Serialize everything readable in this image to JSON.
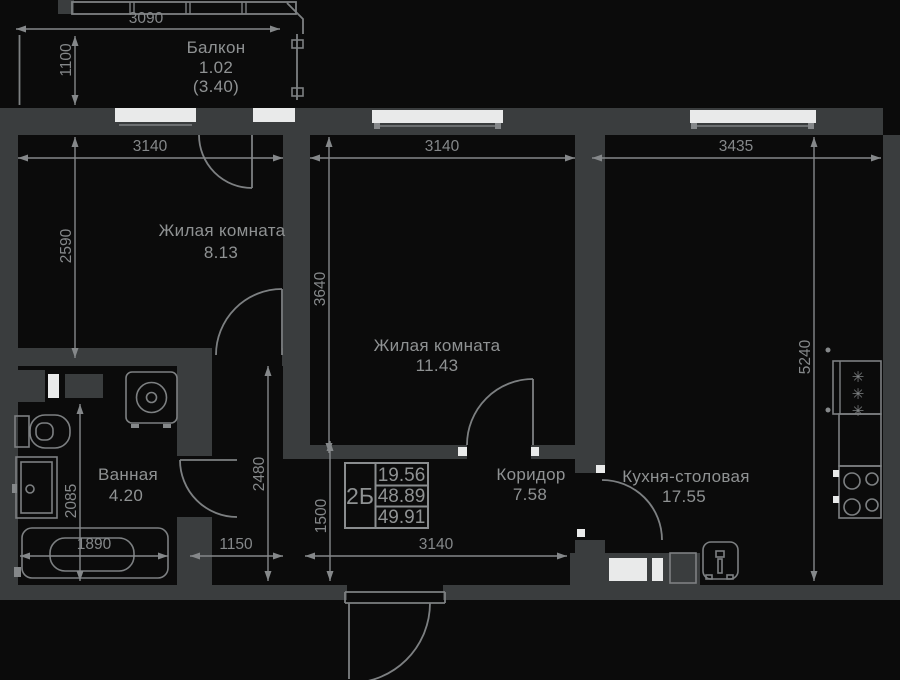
{
  "plan": {
    "balcony": {
      "name": "Балкон",
      "area": "1.02",
      "area_total": "(3.40)"
    },
    "rooms": {
      "living1": {
        "name": "Жилая комната",
        "area": "8.13"
      },
      "living2": {
        "name": "Жилая комната",
        "area": "11.43"
      },
      "bathroom": {
        "name": "Ванная",
        "area": "4.20"
      },
      "corridor": {
        "name": "Коридор",
        "area": "7.58"
      },
      "kitchen": {
        "name": "Кухня-столовая",
        "area": "17.55"
      }
    },
    "stamp": {
      "unit_type": "2Б",
      "living_area": "19.56",
      "apartment_area": "48.89",
      "total_area": "49.91"
    },
    "dimensions": {
      "balcony_width": "3090",
      "balcony_depth": "1100",
      "living1_width": "3140",
      "living1_depth": "2590",
      "living2_width": "3140",
      "living2_depth": "3640",
      "kitchen_width": "3435",
      "kitchen_depth": "5240",
      "hall_depth": "2480",
      "corridor_depth": "1500",
      "bathroom_depth": "2085",
      "bathtub_width": "1890",
      "hall_width": "1150",
      "corridor_width": "3140"
    },
    "icons": {
      "fridge_glyph": "✳"
    },
    "colors": {
      "background": "#0b0b0b",
      "wall": "#3a3d3e",
      "line": "#7d8082",
      "text": "#8f9293",
      "pane": "#e9eaea"
    }
  }
}
